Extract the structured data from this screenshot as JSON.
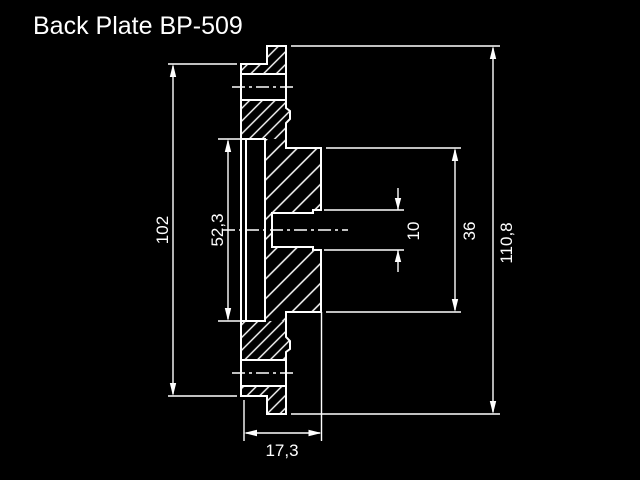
{
  "title": "Back Plate BP-509",
  "colors": {
    "background": "#000000",
    "line": "#ffffff"
  },
  "drawing": {
    "type": "technical-cross-section",
    "dims": {
      "d102": "102",
      "d52_3": "52,3",
      "d10": "10",
      "d36": "36",
      "d110_8": "110,8",
      "d17_3": "17,3"
    }
  }
}
